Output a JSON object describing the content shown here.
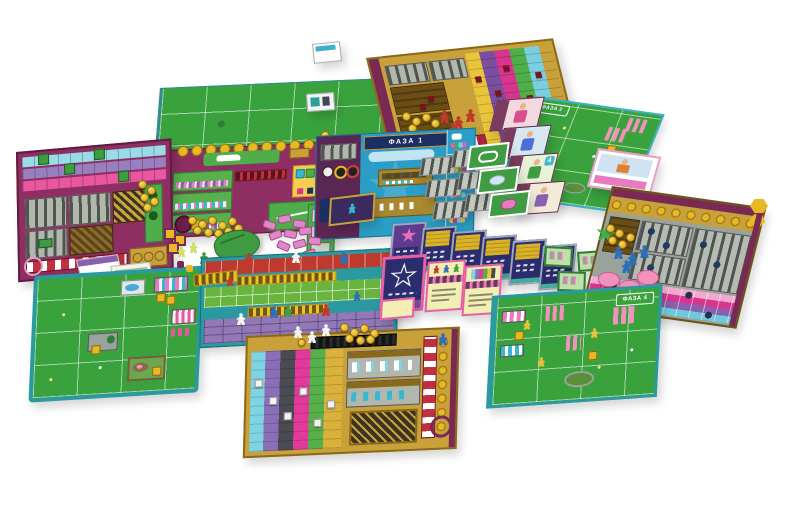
{
  "scene": {
    "type": "board game components spread on white background",
    "background": "#ffffff"
  },
  "labels": {
    "phase1": "ФАЗА 1",
    "phase2": "ФАЗА 2",
    "phase3": "ФАЗА 3",
    "phase4": "ФАЗА 4",
    "character_card_badge": "4"
  },
  "palette": {
    "field_green": "#3aa23c",
    "board_teal": "#2a9aa0",
    "board_magenta": "#8f2e63",
    "board_blue": "#2a9ec6",
    "gold_frame": "#c9a13b",
    "coin_gold": "#e8b923",
    "track_purple": "#8a5fb0",
    "track_magenta": "#d8358f",
    "track_cyan": "#7fd4e4",
    "track_green": "#56b04a",
    "track_yellow": "#e9c53c",
    "track_red": "#b02840",
    "card_navy": "#2b2d6e",
    "card_pink": "#e85fa8",
    "meeple_red": "#c0392b",
    "meeple_blue": "#2e6fba",
    "meeple_green": "#3f9c42",
    "meeple_white": "#f4f4f4",
    "meeple_yellow": "#e8c33a",
    "pig_pink": "#f291bd"
  }
}
